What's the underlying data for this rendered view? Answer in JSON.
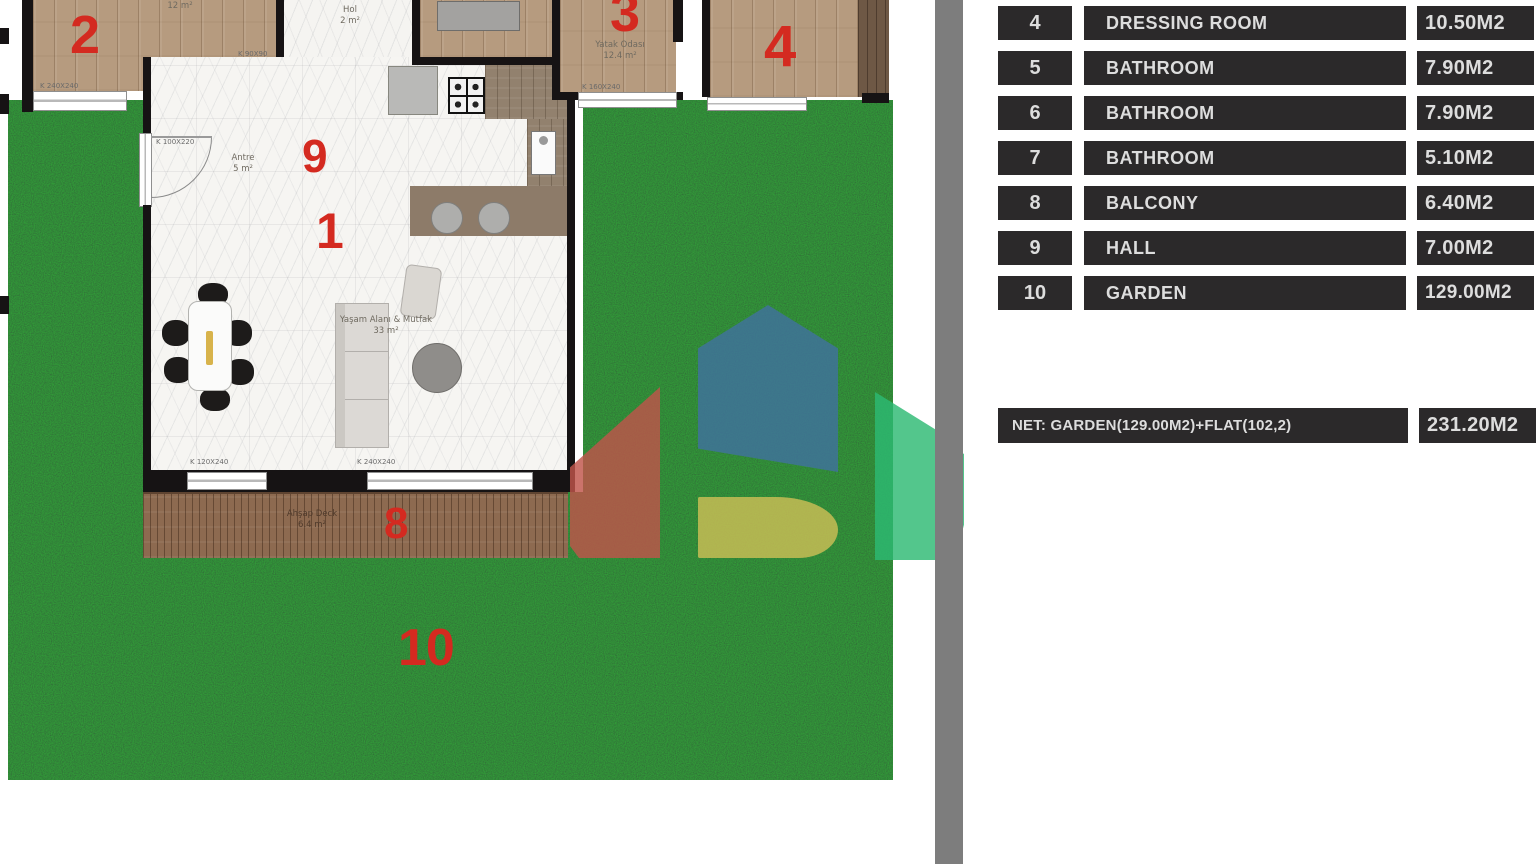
{
  "plan": {
    "numbers": {
      "n1": "1",
      "n2": "2",
      "n3": "3",
      "n4": "4",
      "n8": "8",
      "n9": "9",
      "n10": "10"
    },
    "rooms": {
      "room2_area": "12 m²",
      "hall_name": "Hol",
      "hall_area": "2 m²",
      "bedroom_name": "Yatak Odası",
      "bedroom_area": "12.4 m²",
      "antre_name": "Antre",
      "antre_area": "5 m²",
      "living_name": "Yaşam Alanı & Mutfak",
      "living_area": "33 m²",
      "deck_name": "Ahşap Deck",
      "deck_area": "6.4 m²"
    },
    "windows": {
      "room2_window": "K 240X240",
      "hall_window": "K 90X90",
      "bedroom_window": "K 160X240",
      "entry_door": "K 100X220",
      "living_window_small": "K 120X240",
      "living_window_large": "K 240X240"
    }
  },
  "legend": {
    "rows": [
      {
        "no": "4",
        "name": "DRESSING ROOM",
        "area": "10.50M2"
      },
      {
        "no": "5",
        "name": "BATHROOM",
        "area": "7.90M2"
      },
      {
        "no": "6",
        "name": "BATHROOM",
        "area": "7.90M2"
      },
      {
        "no": "7",
        "name": "BATHROOM",
        "area": "5.10M2"
      },
      {
        "no": "8",
        "name": "BALCONY",
        "area": "6.40M2"
      },
      {
        "no": "9",
        "name": "HALL",
        "area": "7.00M2"
      },
      {
        "no": "10",
        "name": "GARDEN",
        "area": "129.00M2"
      }
    ],
    "net_label": "NET: GARDEN(129.00M2)+FLAT(102,2)",
    "net_value": "231.20M2"
  },
  "colors": {
    "accent_red": "#d42a20",
    "cell_bg": "#2b292a",
    "grass_green": "#1c5e25",
    "divider_gray": "#7d7d7d",
    "logo_red": "#c0544a",
    "logo_blue": "#41719d",
    "logo_yellow": "#cdbe55",
    "logo_green": "#2db973"
  }
}
